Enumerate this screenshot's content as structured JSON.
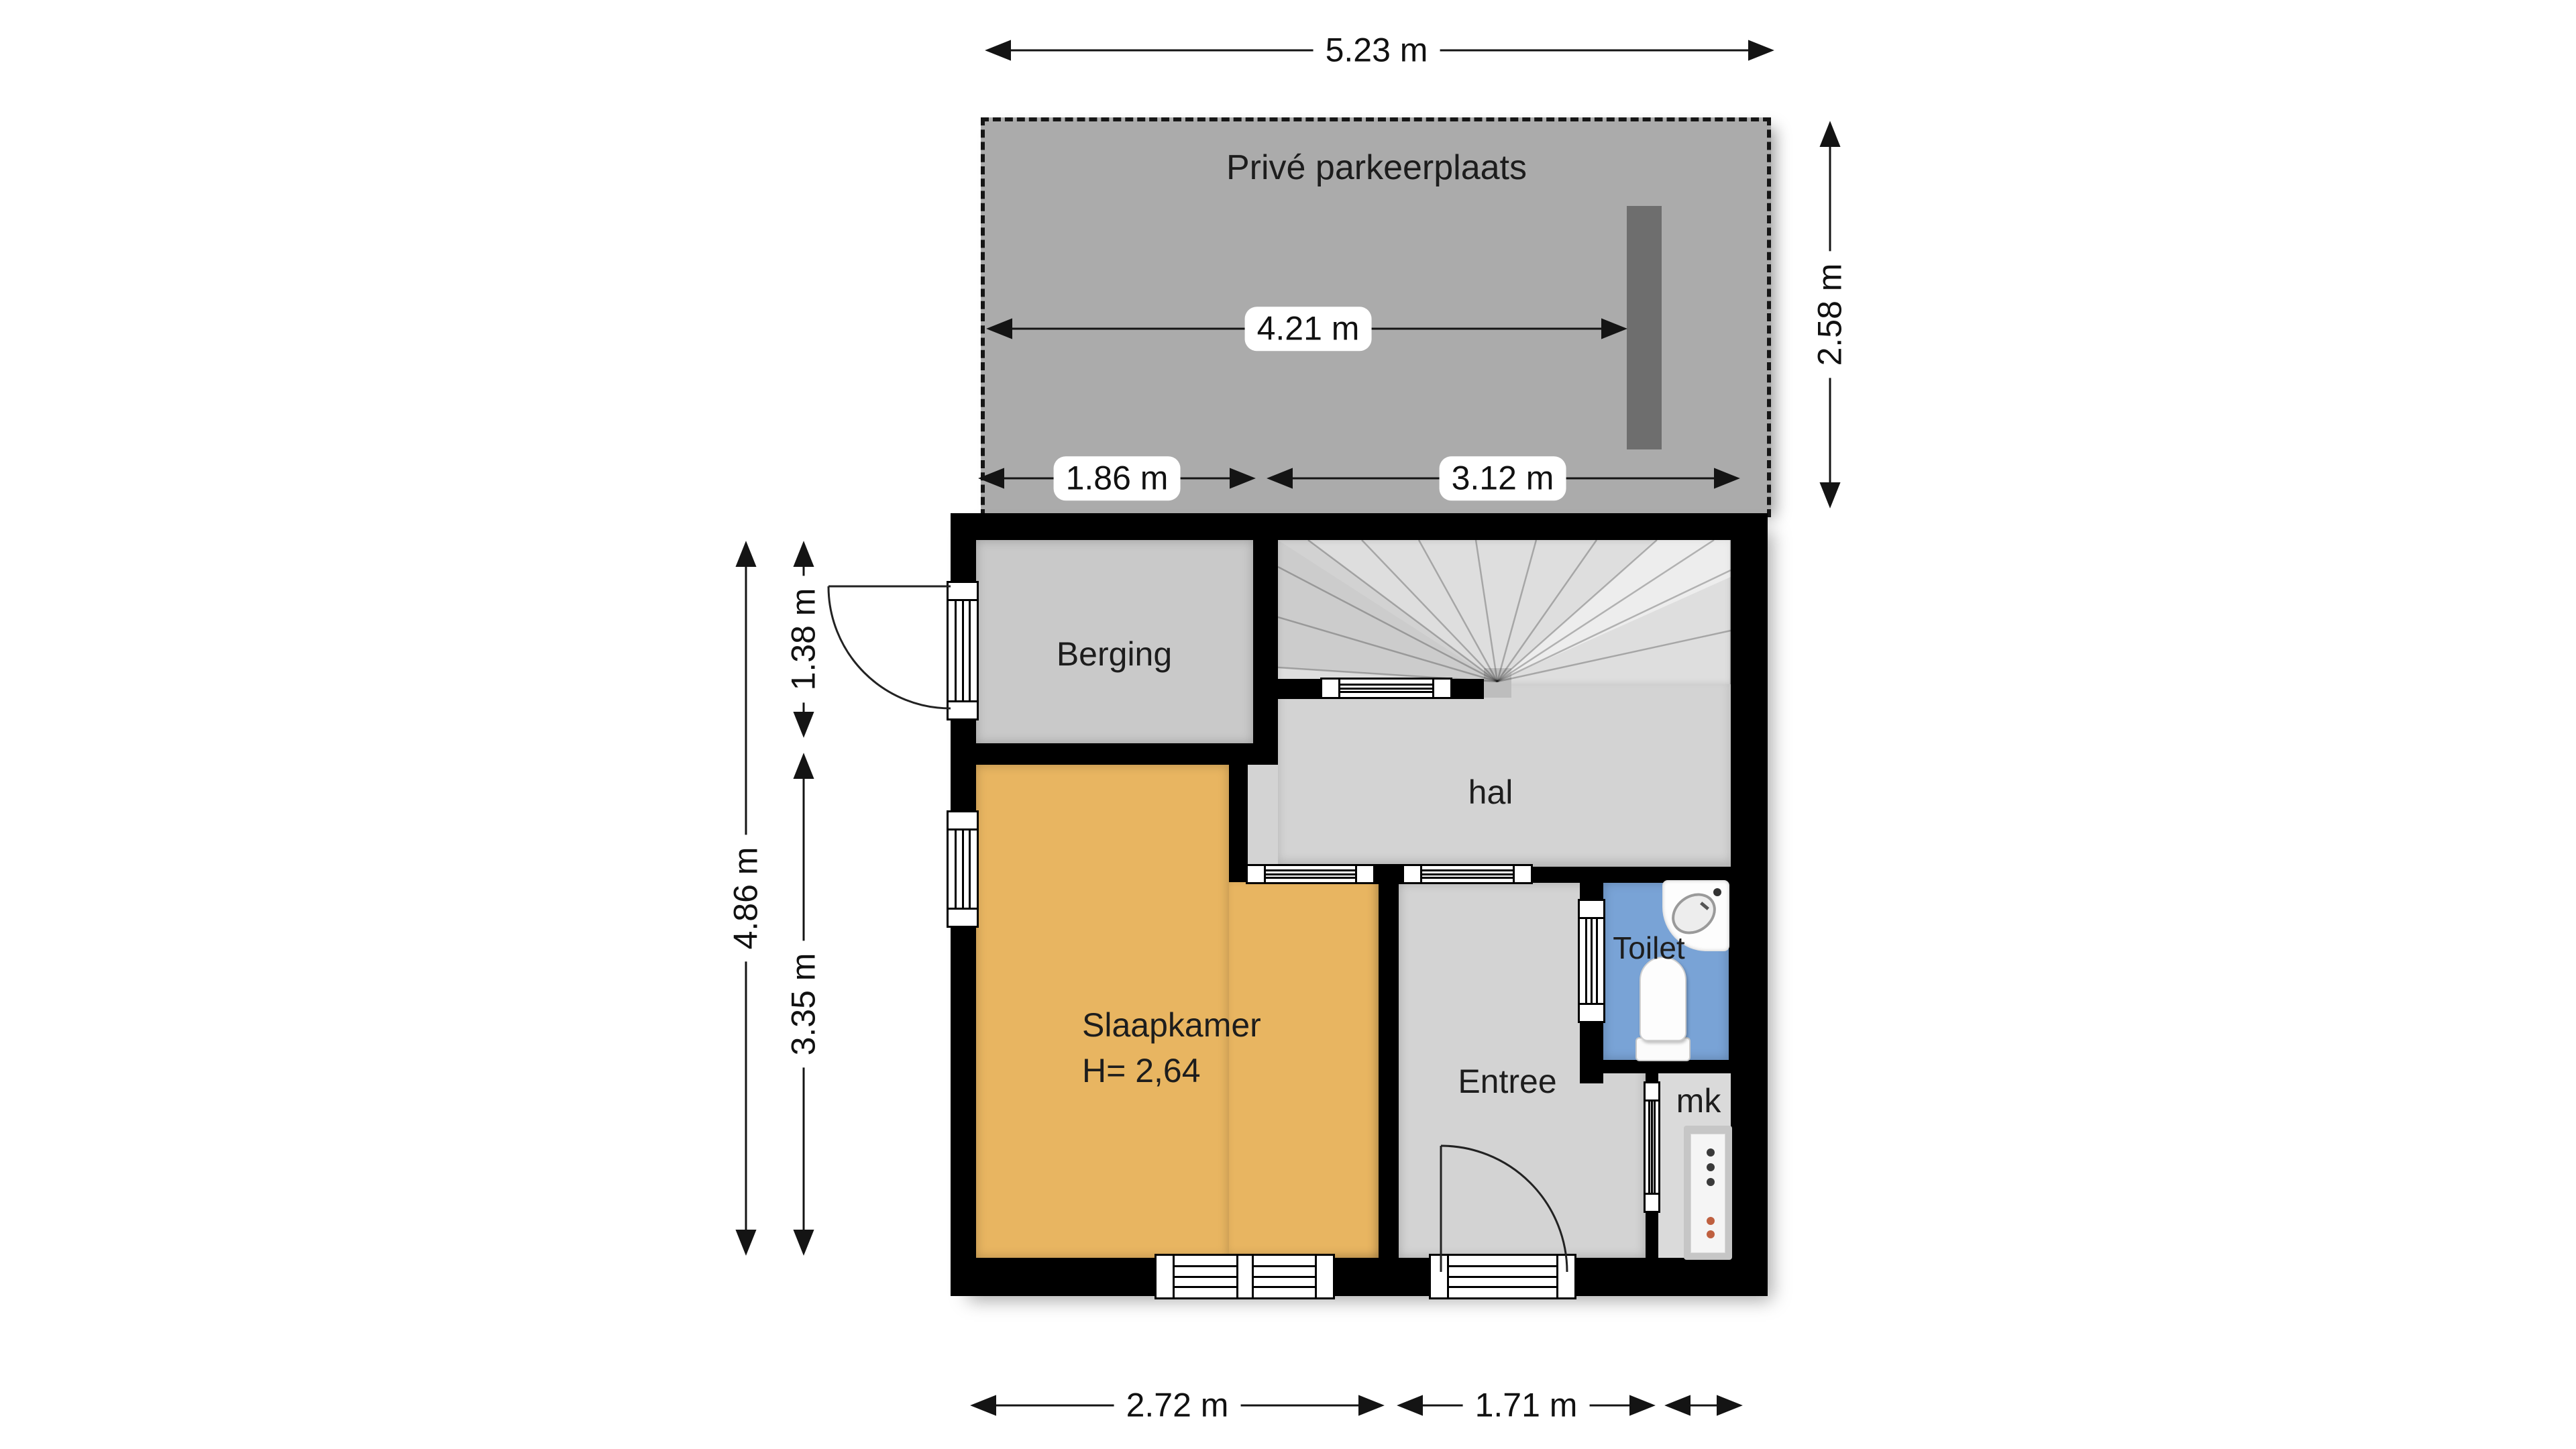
{
  "parking": {
    "label": "Privé parkeerplaats"
  },
  "rooms": {
    "berging": {
      "label": "Berging"
    },
    "hal": {
      "label": "hal"
    },
    "slaapkamer": {
      "label": "Slaapkamer",
      "height": "H= 2,64"
    },
    "toilet": {
      "label": "Toilet"
    },
    "entree": {
      "label": "Entree"
    },
    "mk": {
      "label": "mk"
    }
  },
  "dimensions": {
    "parking_width": "5.23 m",
    "parking_inner_width": "4.21 m",
    "parking_left_section": "1.86 m",
    "parking_right_section": "3.12 m",
    "parking_depth": "2.58 m",
    "house_left_total": "4.86 m",
    "house_left_upper": "1.38 m",
    "house_left_lower": "3.35 m",
    "bottom_slaapkamer": "2.72 m",
    "bottom_entree": "1.71 m"
  },
  "colors": {
    "wall": "#000000",
    "parking_floor": "#ababab",
    "parking_bar": "#6e6e6e",
    "berging_floor": "#c9c9c9",
    "stairs_floor": "#dedede",
    "hal_floor": "#d3d3d3",
    "entree_floor": "#d3d3d3",
    "slaapkamer_floor": "#e8b561",
    "toilet_floor": "#79a3d6",
    "mk_floor": "#dadada"
  }
}
